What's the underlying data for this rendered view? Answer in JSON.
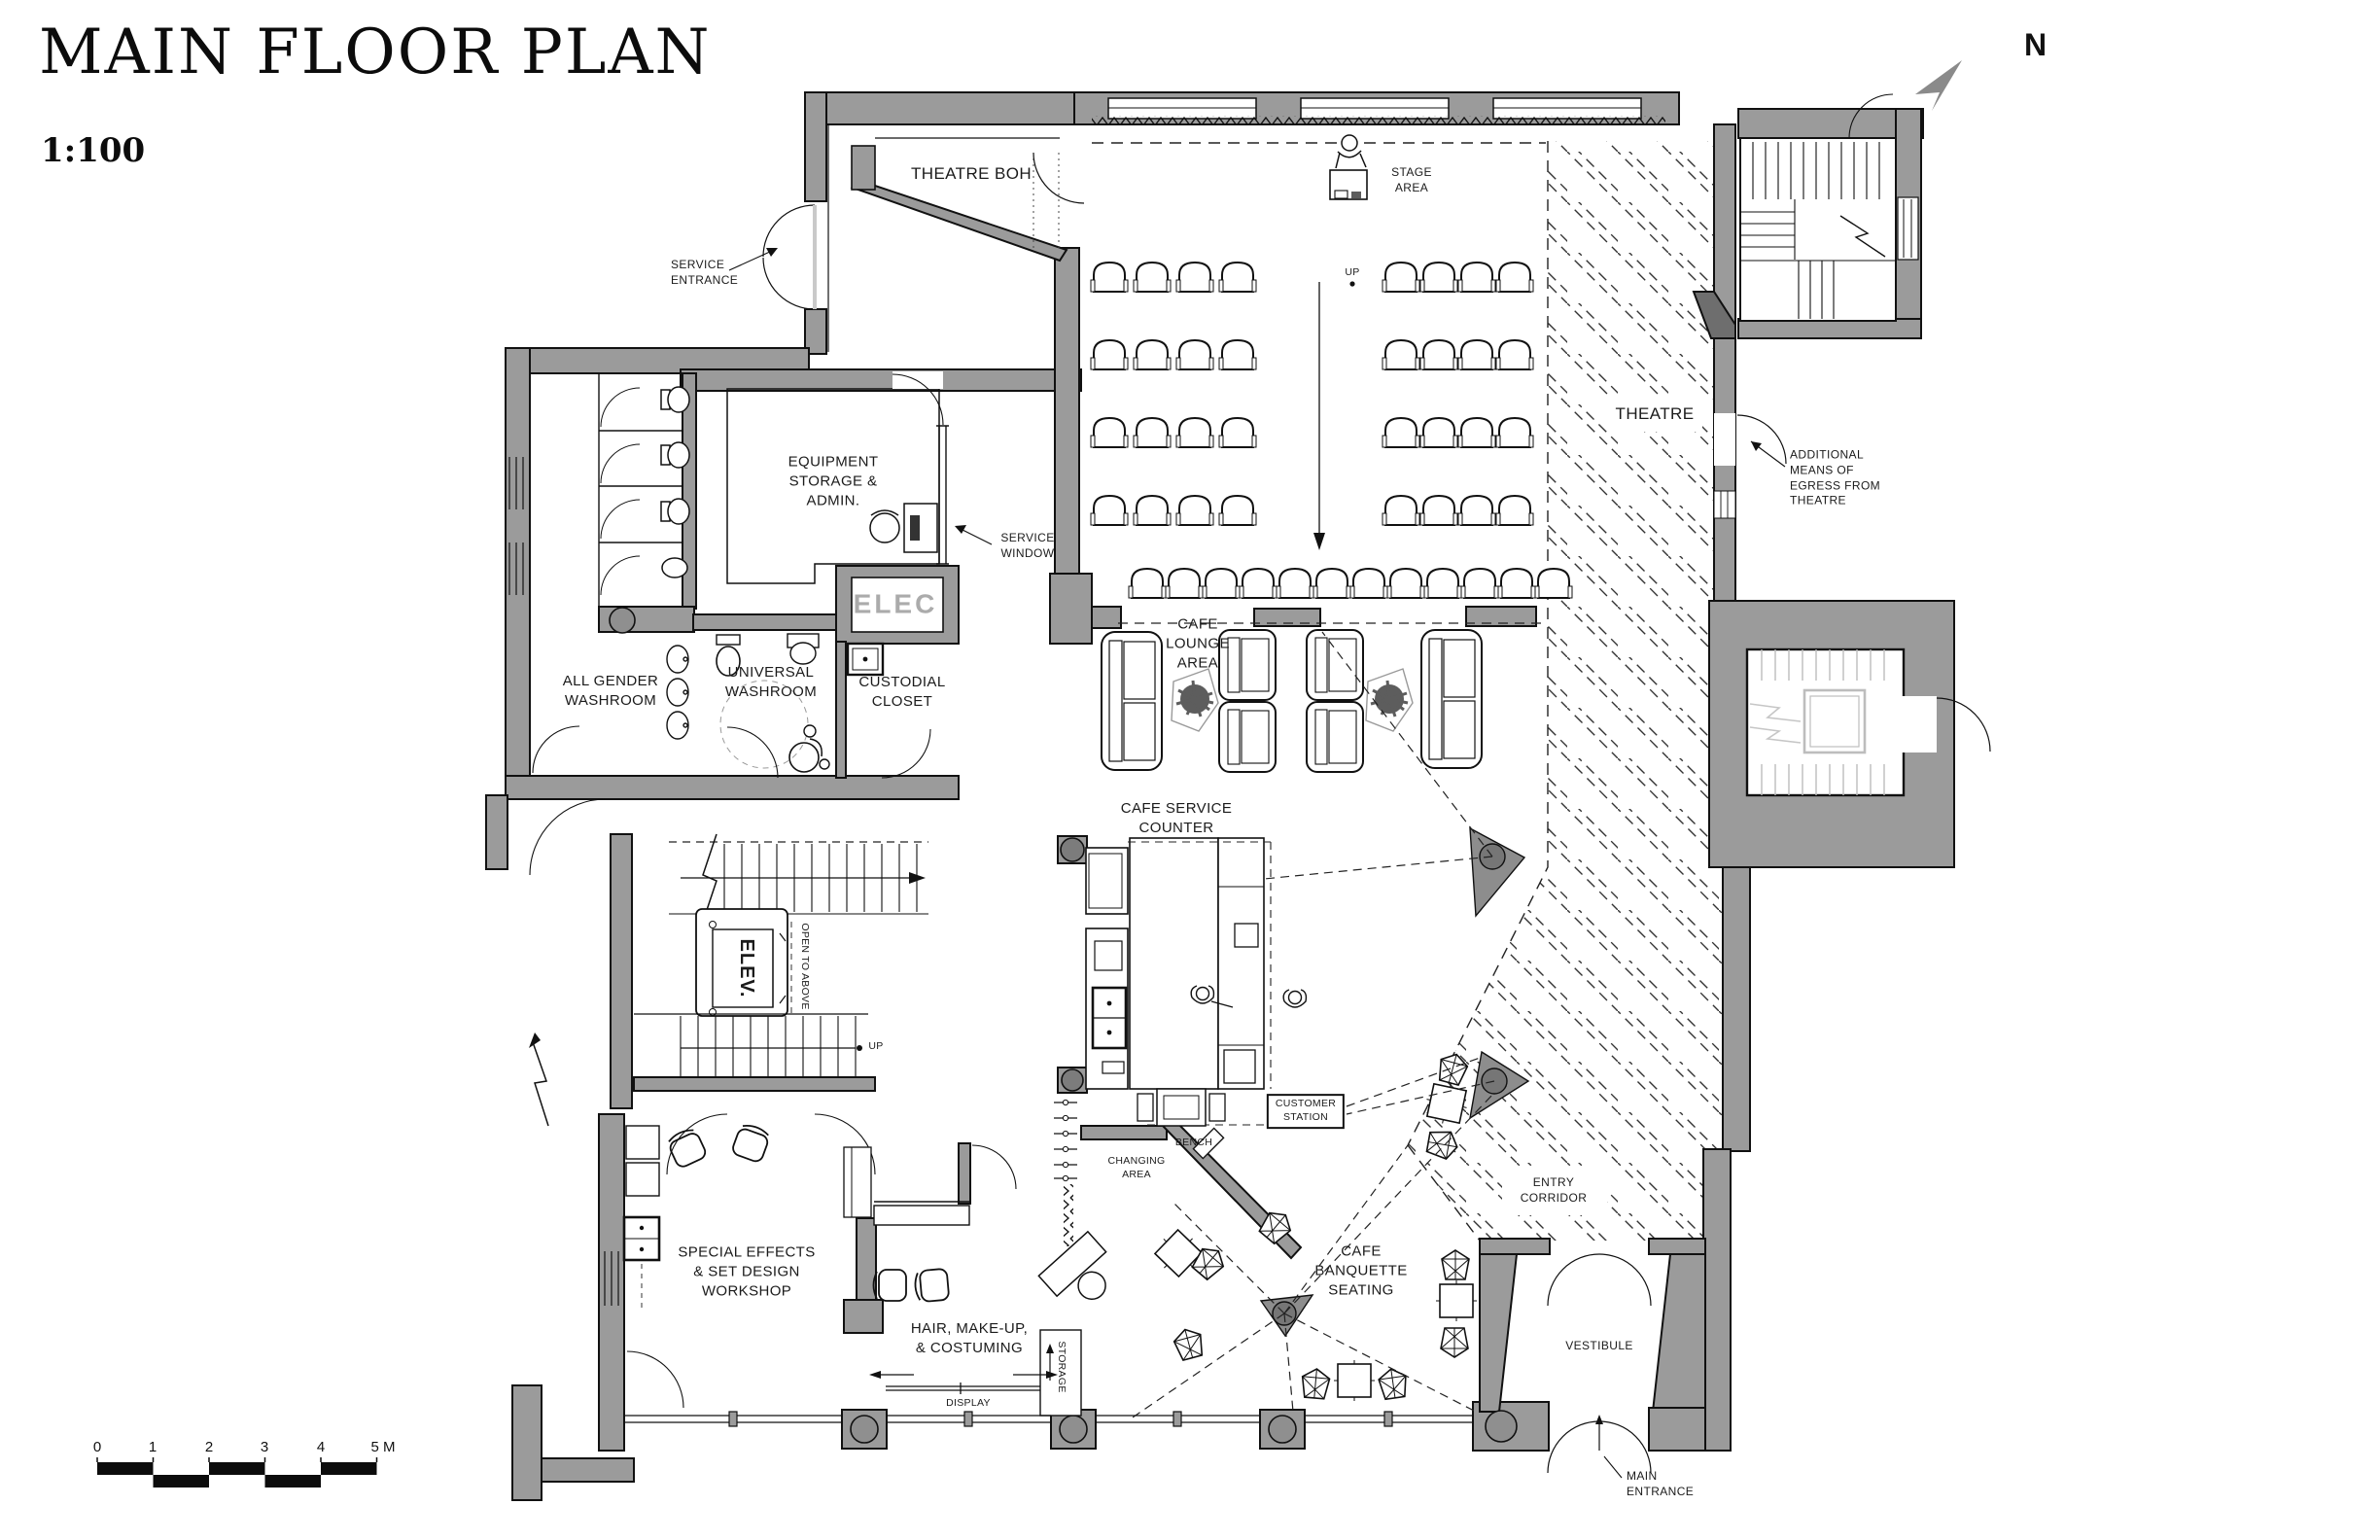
{
  "header": {
    "title": "MAIN FLOOR PLAN",
    "scale": "1:100",
    "north_label": "N"
  },
  "rooms": {
    "theatre_boh": "THEATRE BOH",
    "stage_area": "STAGE\nAREA",
    "theatre": "THEATRE",
    "equipment_storage": "EQUIPMENT\nSTORAGE &\nADMIN.",
    "elec": "ELEC",
    "all_gender_washroom": "ALL GENDER\nWASHROOM",
    "universal_washroom": "UNIVERSAL\nWASHROOM",
    "custodial_closet": "CUSTODIAL\nCLOSET",
    "cafe_lounge": "CAFE\nLOUNGE\nAREA",
    "cafe_service_counter": "CAFE SERVICE\nCOUNTER",
    "customer_station": "CUSTOMER\nSTATION",
    "changing_area": "CHANGING\nAREA",
    "cafe_banquette": "CAFE\nBANQUETTE\nSEATING",
    "entry_corridor": "ENTRY\nCORRIDOR",
    "vestibule": "VESTIBULE",
    "special_effects_workshop": "SPECIAL EFFECTS\n& SET DESIGN\nWORKSHOP",
    "hair_makeup": "HAIR, MAKE-UP,\n& COSTUMING",
    "elevator": "ELEV.",
    "open_to_above": "OPEN TO ABOVE",
    "storage": "STORAGE"
  },
  "annotations": {
    "service_entrance": "SERVICE\nENTRANCE",
    "service_window": "SERVICE\nWINDOW",
    "egress_note": "ADDITIONAL\nMEANS OF\nEGRESS FROM\nTHEATRE",
    "main_entrance": "MAIN\nENTRANCE",
    "bench": "BENCH",
    "display": "DISPLAY",
    "up_theatre": "UP",
    "up_stair": "UP"
  },
  "scale_bar": {
    "ticks": [
      "0",
      "1",
      "2",
      "3",
      "4",
      "5 M"
    ]
  }
}
